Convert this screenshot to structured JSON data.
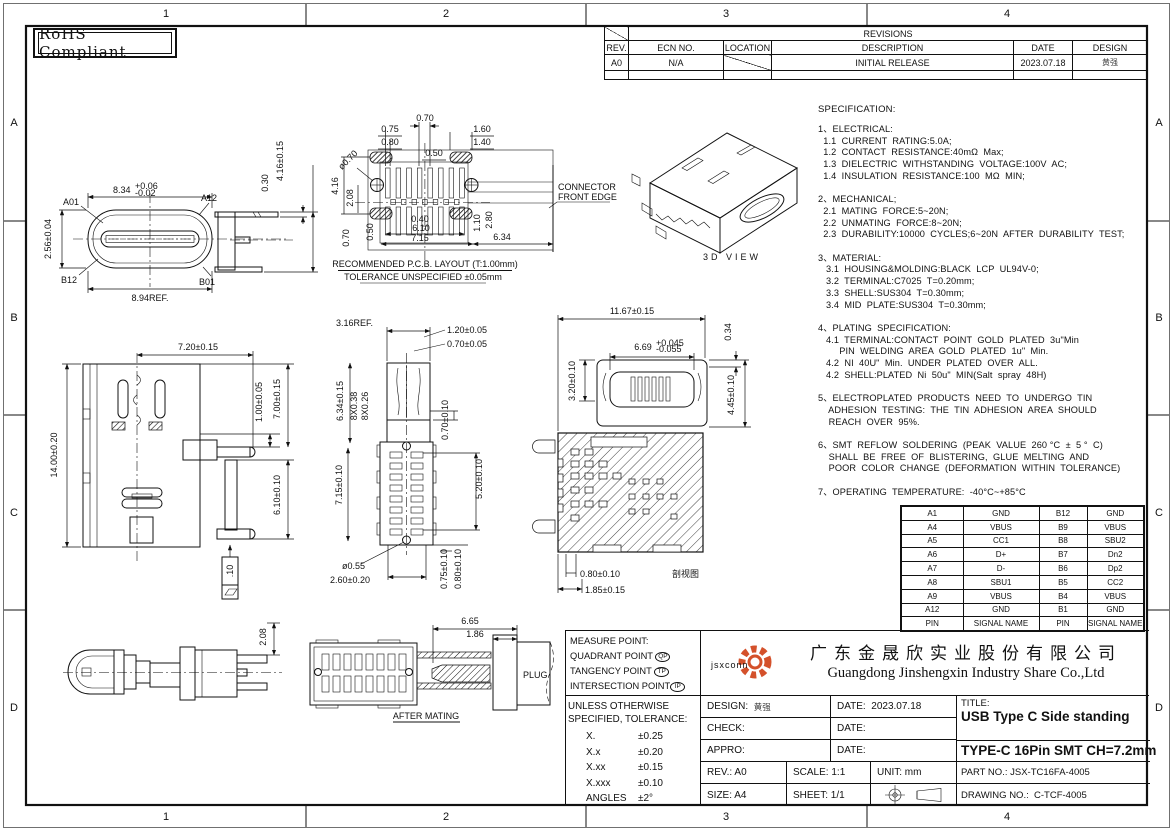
{
  "sheet": {
    "zone_cols": [
      "1",
      "2",
      "3",
      "4"
    ],
    "zone_rows": [
      "A",
      "B",
      "C",
      "D"
    ],
    "rohs": "RoHS Compliant"
  },
  "revisions": {
    "title": "REVISIONS",
    "h_rev": "REV.",
    "h_ecn": "ECN  NO.",
    "h_loc": "LOCATION",
    "h_desc": "DESCRIPTION",
    "h_date": "DATE",
    "h_design": "DESIGN",
    "r_rev": "A0",
    "r_ecn": "N/A",
    "r_desc": "INITIAL  RELEASE",
    "r_date": "2023.07.18",
    "r_design": "黄强"
  },
  "spec": {
    "title": "SPECIFICATION:",
    "text": "1、ELECTRICAL:\n  1.1  CURRENT  RATING:5.0A;\n  1.2  CONTACT  RESISTANCE:40mΩ  Max;\n  1.3  DIELECTRIC  WITHSTANDING  VOLTAGE:100V  AC;\n  1.4  INSULATION  RESISTANCE:100  MΩ  MIN;\n\n2、MECHANICAL;\n  2.1  MATING  FORCE:5~20N;\n  2.2  UNMATING  FORCE:8~20N;\n  2.3  DURABILITY:10000  CYCLES;6~20N  AFTER  DURABILITY  TEST;\n\n3、MATERIAL:\n   3.1  HOUSING&MOLDING:BLACK  LCP  UL94V-0;\n   3.2  TERMINAL:C7025  T=0.20mm;\n   3.3  SHELL:SUS304  T=0.30mm;\n   3.4  MID  PLATE:SUS304  T=0.30mm;\n\n4、PLATING  SPECIFICATION:\n   4.1  TERMINAL:CONTACT  POINT  GOLD  PLATED  3u\"Min\n        PIN  WELDING  AREA  GOLD  PLATED  1u\"  Min.\n   4.2  NI  40U\"  Min.  UNDER  PLATED  OVER  ALL.\n   4.2  SHELL:PLATED  Ni  50u\"  MIN(Salt  spray  48H)\n\n5、ELECTROPLATED  PRODUCTS  NEED  TO  UNDERGO  TIN\n    ADHESION  TESTING:  THE  TIN  ADHESION  AREA  SHOULD\n    REACH  OVER  95%.\n\n6、SMT  REFLOW  SOLDERING  (PEAK  VALUE  260 °C  ±  5 °  C)\n    SHALL  BE  FREE  OF  BLISTERING,  GLUE  MELTING  AND\n    POOR  COLOR  CHANGE  (DEFORMATION  WITHIN  TOLERANCE)\n\n7、OPERATING  TEMPERATURE:  -40°C~+85°C"
  },
  "views": {
    "front": {
      "h": "2.56±0.04",
      "w": "8.34",
      "w_up": "+0.06",
      "w_dn": "-0.02",
      "a01": "A01",
      "a12": "A12",
      "b12": "B12",
      "b01": "B01",
      "ref": "8.94REF.",
      "leg_t": "0.30",
      "leg_h": "4.16±0.15"
    },
    "pcb": {
      "d075": "0.75",
      "d080": "0.80",
      "d070": "0.70",
      "d050": "0.50",
      "d160": "1.60",
      "d140": "1.40",
      "hole": "ø0.70",
      "d416": "4.16",
      "d208": "2.08",
      "dv070": "0.70",
      "dv050": "0.50",
      "d040": "0.40",
      "d610": "6.10",
      "d715": "7.15",
      "d110": "1.10",
      "d280": "2.80",
      "d634": "6.34",
      "note1": "CONNECTOR",
      "note2": "FRONT EDGE",
      "cap1": "RECOMMENDED    P.C.B.  LAYOUT  (T:1.00mm)",
      "cap2": "TOLERANCE  UNSPECIFIED  ±0.05mm"
    },
    "iso": {
      "label": "3D  VIEW"
    },
    "side": {
      "w": "7.20±0.15",
      "h": "14.00±0.20",
      "d1": "1.00±0.05",
      "d2": "7.00±0.15",
      "d3": "6.10±0.10",
      "flat": ".10"
    },
    "bottom": {
      "ref": "3.16REF.",
      "t1": "1.20±0.05",
      "t2": "0.70±0.05",
      "l1": "6.34±0.15",
      "l2": "8X0.38",
      "l3": "8X0.26",
      "l4": "7.15±0.10",
      "r1": "0.70±0.10",
      "r2": "5.20±0.10",
      "b1": "ø0.55",
      "b2": "2.60±0.20",
      "b3": "0.75±0.10",
      "b4": "0.80±0.10"
    },
    "section": {
      "w": "11.67±0.15",
      "l1": "3.20±0.10",
      "mid": "6.69",
      "mid_up": "+0.045",
      "mid_dn": "-0.055",
      "r1": "0.34",
      "r2": "4.45±0.10",
      "b1": "0.80±0.10",
      "b2": "1.85±0.15",
      "caption": "剖视图"
    },
    "profile": {
      "d1": "2.08"
    },
    "mating": {
      "d1": "6.65",
      "d2": "1.86",
      "plug": "PLUG",
      "caption": "AFTER  MATING"
    }
  },
  "pins": {
    "rows": [
      {
        "pa": "A1",
        "sa": "GND",
        "pb": "B12",
        "sb": "GND"
      },
      {
        "pa": "A4",
        "sa": "VBUS",
        "pb": "B9",
        "sb": "VBUS"
      },
      {
        "pa": "A5",
        "sa": "CC1",
        "pb": "B8",
        "sb": "SBU2"
      },
      {
        "pa": "A6",
        "sa": "D+",
        "pb": "B7",
        "sb": "Dn2"
      },
      {
        "pa": "A7",
        "sa": "D-",
        "pb": "B6",
        "sb": "Dp2"
      },
      {
        "pa": "A8",
        "sa": "SBU1",
        "pb": "B5",
        "sb": "CC2"
      },
      {
        "pa": "A9",
        "sa": "VBUS",
        "pb": "B4",
        "sb": "VBUS"
      },
      {
        "pa": "A12",
        "sa": "GND",
        "pb": "B1",
        "sb": "GND"
      }
    ],
    "f_pin": "PIN",
    "f_sig": "SIGNAL  NAME",
    "f_pin2": "PIN",
    "f_sig2": "SIGNAL  NAME"
  },
  "title_block": {
    "measure": {
      "t": "MEASURE  POINT:",
      "q": "QUADRANT  POINT",
      "qb": "QP",
      "tg": "TANGENCY  POINT",
      "tgb": "TP",
      "i": "INTERSECTION  POINT",
      "ib": "IP"
    },
    "tol": {
      "l1": "UNLESS  OTHERWISE",
      "l2": "SPECIFIED,  TOLERANCE:",
      "rows": [
        {
          "k": "X.",
          "v": "±0.25"
        },
        {
          "k": "X.x",
          "v": "±0.20"
        },
        {
          "k": "X.xx",
          "v": "±0.15"
        },
        {
          "k": "X.xxx",
          "v": "±0.10"
        },
        {
          "k": "ANGLES",
          "v": "±2°"
        }
      ]
    },
    "company": {
      "logo": "jsxconn",
      "cn": "广东金晟欣实业股份有限公司",
      "en": "Guangdong Jinshengxin Industry Share Co.,Ltd"
    },
    "fields": {
      "design": "DESIGN:",
      "design_v": "黄强",
      "date1": "DATE:",
      "date1_v": "2023.07.18",
      "check": "CHECK:",
      "date2": "DATE:",
      "appro": "APPRO:",
      "date3": "DATE:",
      "rev": "REV.: A0",
      "scale": "SCALE: 1:1",
      "unit": "UNIT: mm",
      "size": "SIZE: A4",
      "sheet": "SHEET: 1/1"
    },
    "title": {
      "label": "TITLE:",
      "l1": "USB Type C Side standing",
      "l2": "TYPE-C 16Pin SMT  CH=7.2mm",
      "part": "PART  NO.:",
      "part_v": "JSX-TC16FA-4005",
      "dwg": "DRAWING  NO.:",
      "dwg_v": "C-TCF-4005"
    }
  },
  "colors": {
    "logo_orange": "#d4512b"
  }
}
